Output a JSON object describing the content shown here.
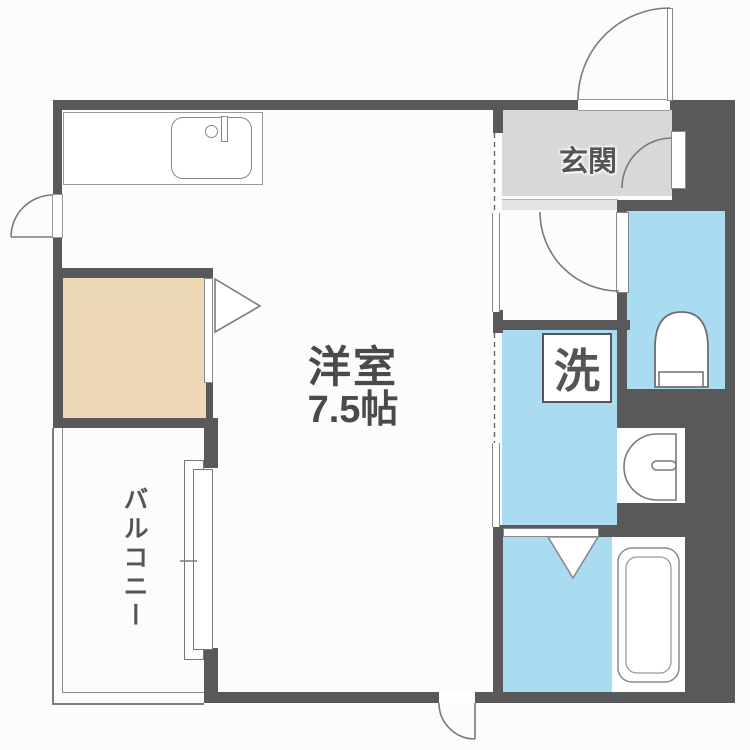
{
  "plan": {
    "main_room": {
      "name": "洋室",
      "size": "7.5帖"
    },
    "entrance_label": "玄関",
    "laundry_label": "洗",
    "balcony_label": "バルコニー"
  },
  "colors": {
    "wall": "#59595b",
    "wet_area_blue": "#a9dcf1",
    "closet_tan": "#eed9b6",
    "entrance_gray": "#d8d8d8",
    "entrance_step_gray": "#e3e3e3",
    "outline_gray": "#7a7a7a",
    "text_gray": "#4a4a4a",
    "background": "#fcfcfc"
  }
}
